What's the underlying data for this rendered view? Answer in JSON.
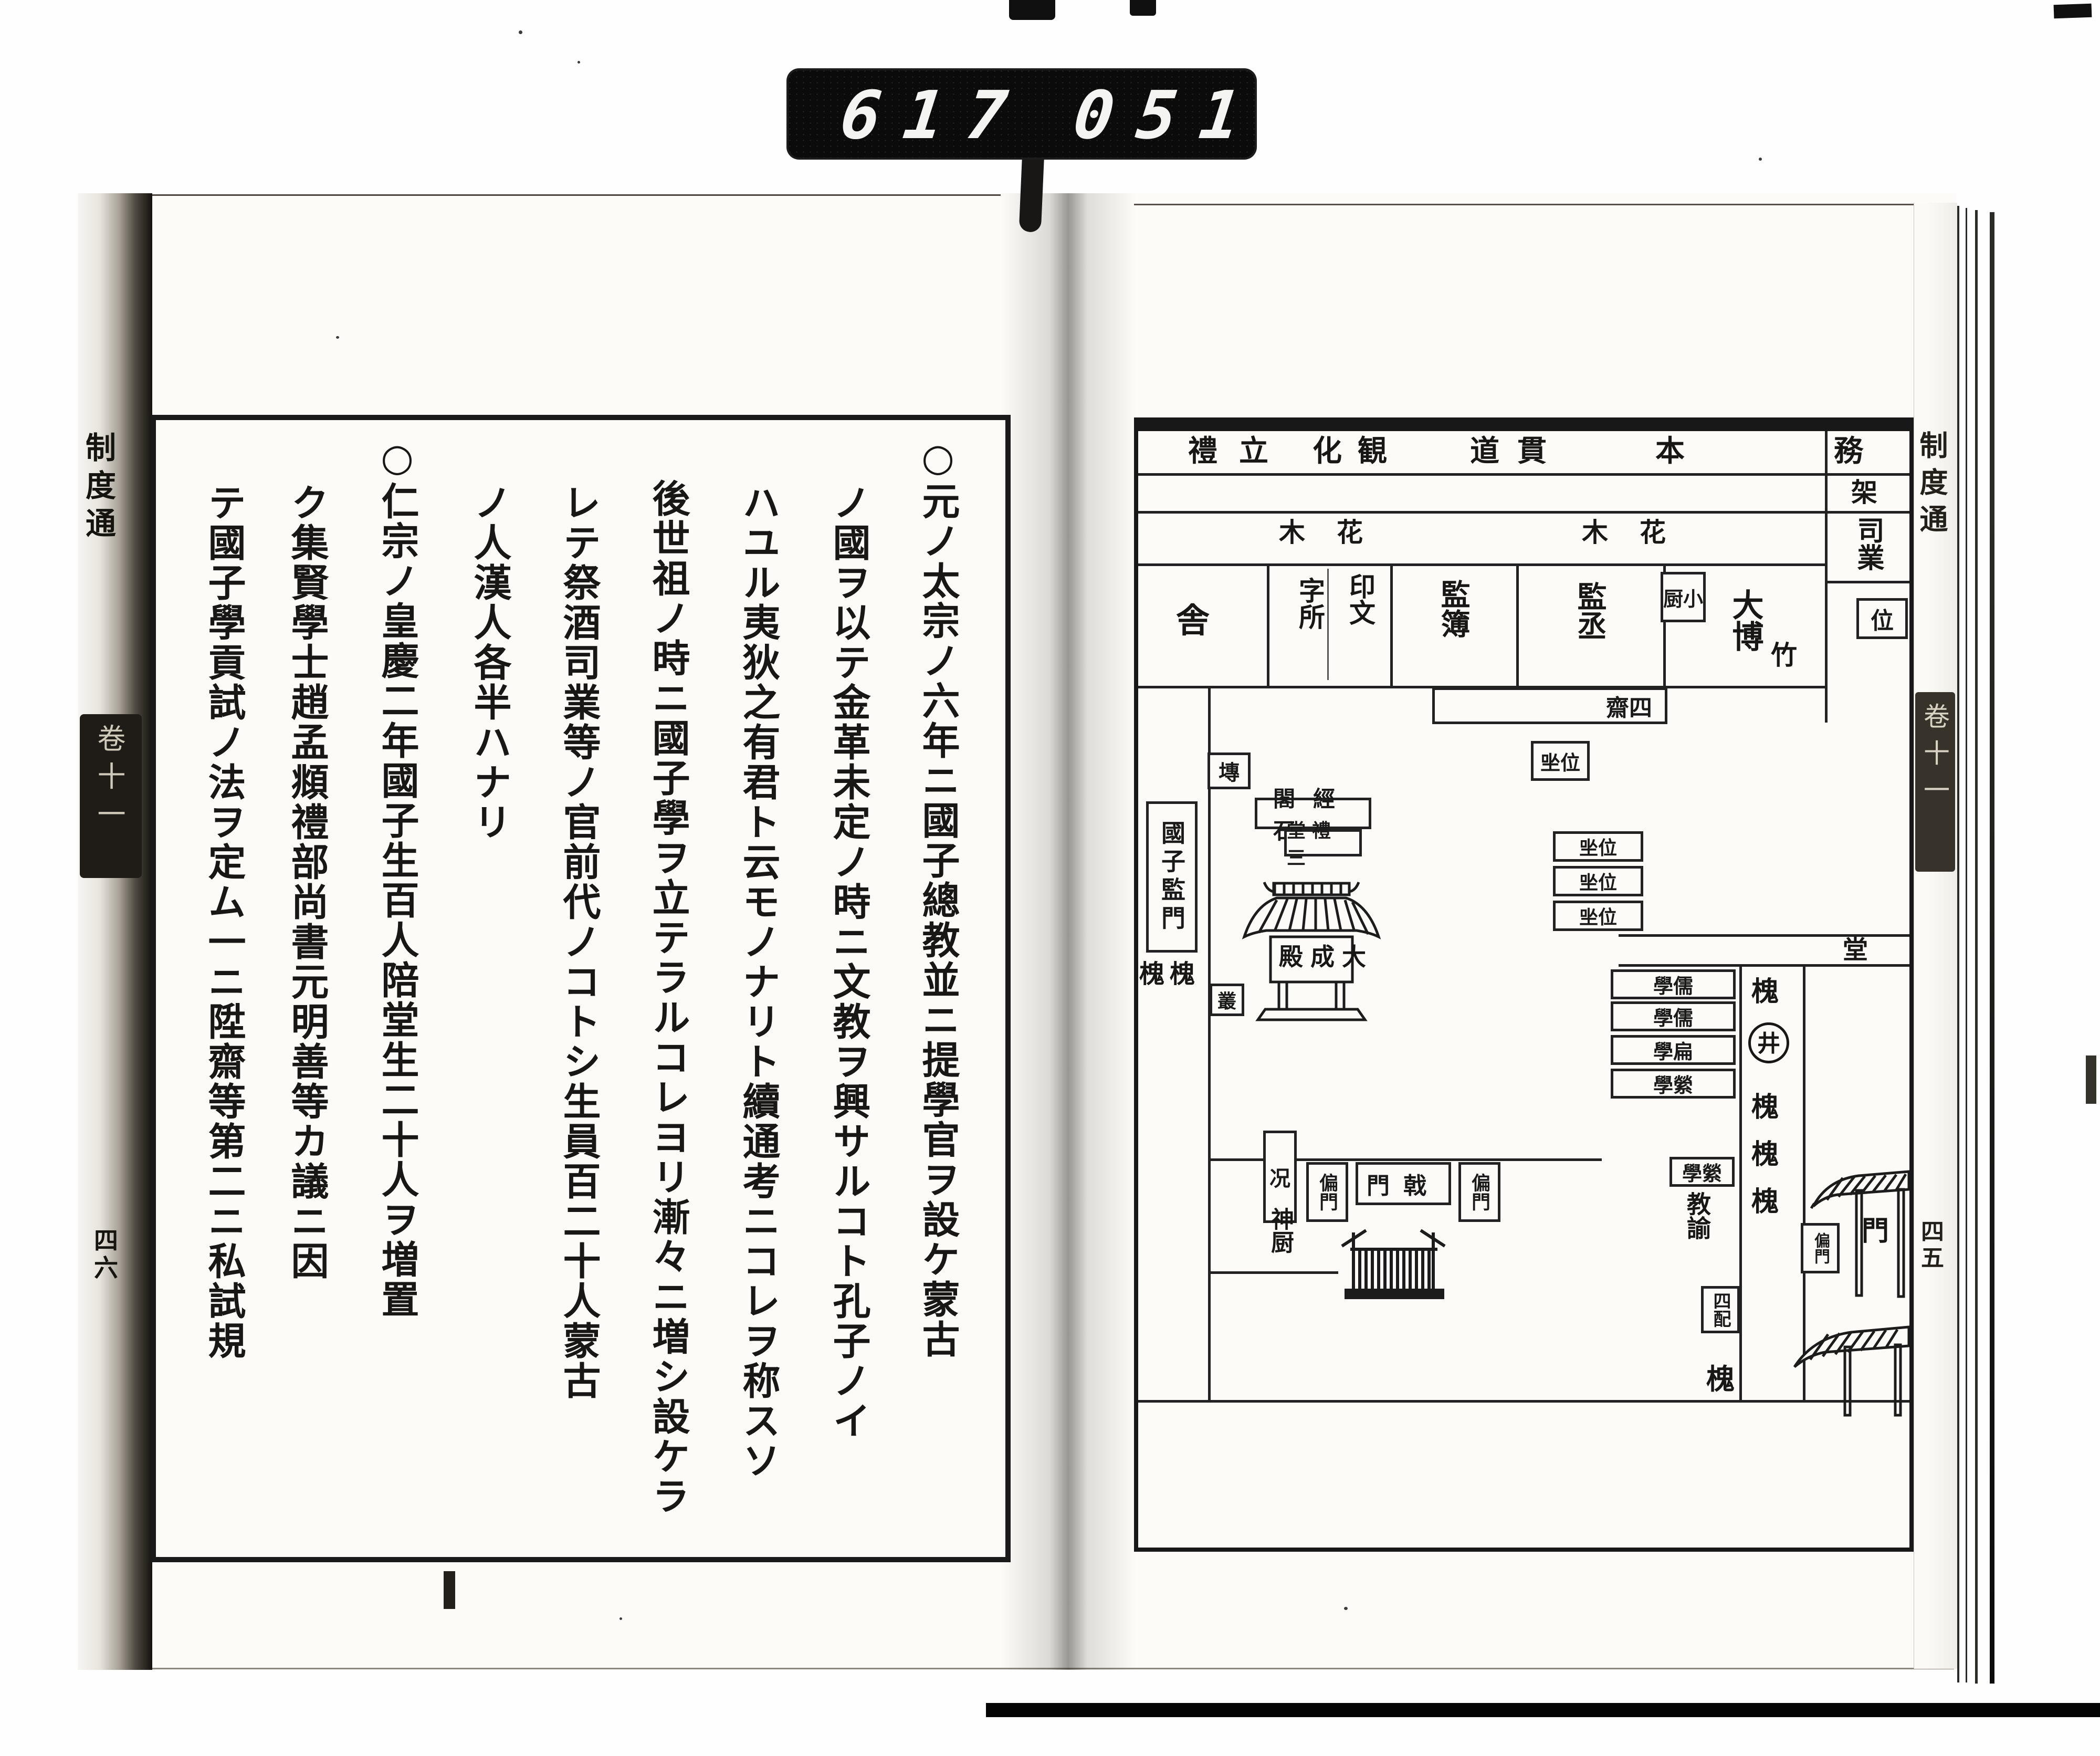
{
  "counter": {
    "group1": "617",
    "group2": "051"
  },
  "book": {
    "left_page": {
      "edge_title": "制度通",
      "edge_volume": "卷十一",
      "edge_folio": "四六",
      "columns": [
        "○元ノ太宗ノ六年ニ國子總教並ニ提學官ヲ設ケ蒙古",
        "ノ國ヲ以テ金革未定ノ時ニ文教ヲ興サルコト孔子ノイ",
        "ハユル夷狄之有君ト云モノナリト續通考ニコレヲ称スソ",
        "後世祖ノ時ニ國子學ヲ立テラルコレヨリ漸々ニ増シ設ケラ",
        "レテ祭酒司業等ノ官前代ノコトシ生員百二十人蒙古",
        "ノ人漢人各半ハナリ",
        "○仁宗ノ皇慶二年國子生百人陪堂生二十人ヲ増置",
        "ク集賢學士趙孟頫禮部尚書元明善等カ議ニ因",
        "テ國子學貢試ノ法ヲ定ム一ニ陞齋等第二ニ私試規"
      ]
    },
    "right_page": {
      "edge_title": "制度通",
      "edge_volume": "卷十一",
      "edge_folio": "四五",
      "diagram": {
        "top_labels": [
          "禮",
          "立",
          "化",
          "観",
          "道",
          "貫",
          "本",
          "務"
        ],
        "garden_left": "木花",
        "garden_right": "木花",
        "rack": "架",
        "cell_sha": "舎",
        "cell_inmon": "印文",
        "cell_jisho": "字所",
        "cell_kanbo": "監簿",
        "cell_kanjo": "監丞",
        "cell_kochu": "厨小",
        "cell_daihaku": "大博",
        "cell_shigyo": "司業",
        "cell_i": "位",
        "cell_take": "竹",
        "cell_shisai": "齋四",
        "cell_dou": "堂",
        "gate_main": "國子監門",
        "trees_west": "槐槐",
        "box_sen": "塼",
        "box_sou": "叢",
        "box_kyo": "况",
        "plaque_sekkei": "閣經石",
        "plaque_sanrei": "堂禮三",
        "hall_taisei": "殿成大",
        "seat_boxes": [
          "㘴位",
          "㘴位",
          "㘴位",
          "㘴位"
        ],
        "row_boxes": [
          "學儒",
          "學儒",
          "學扁",
          "學縈",
          "學縈"
        ],
        "kyoyu": "教諭",
        "tree_col": [
          "槐",
          "井",
          "槐",
          "槐",
          "槐"
        ],
        "mon": "門",
        "henmon_small": "偏門",
        "henmon_left": "偏門",
        "gekimon": "門戟",
        "henmon_right": "偏門",
        "shinchu": "神厨",
        "shihai": "四配",
        "tree_bottom": "槐"
      }
    }
  }
}
